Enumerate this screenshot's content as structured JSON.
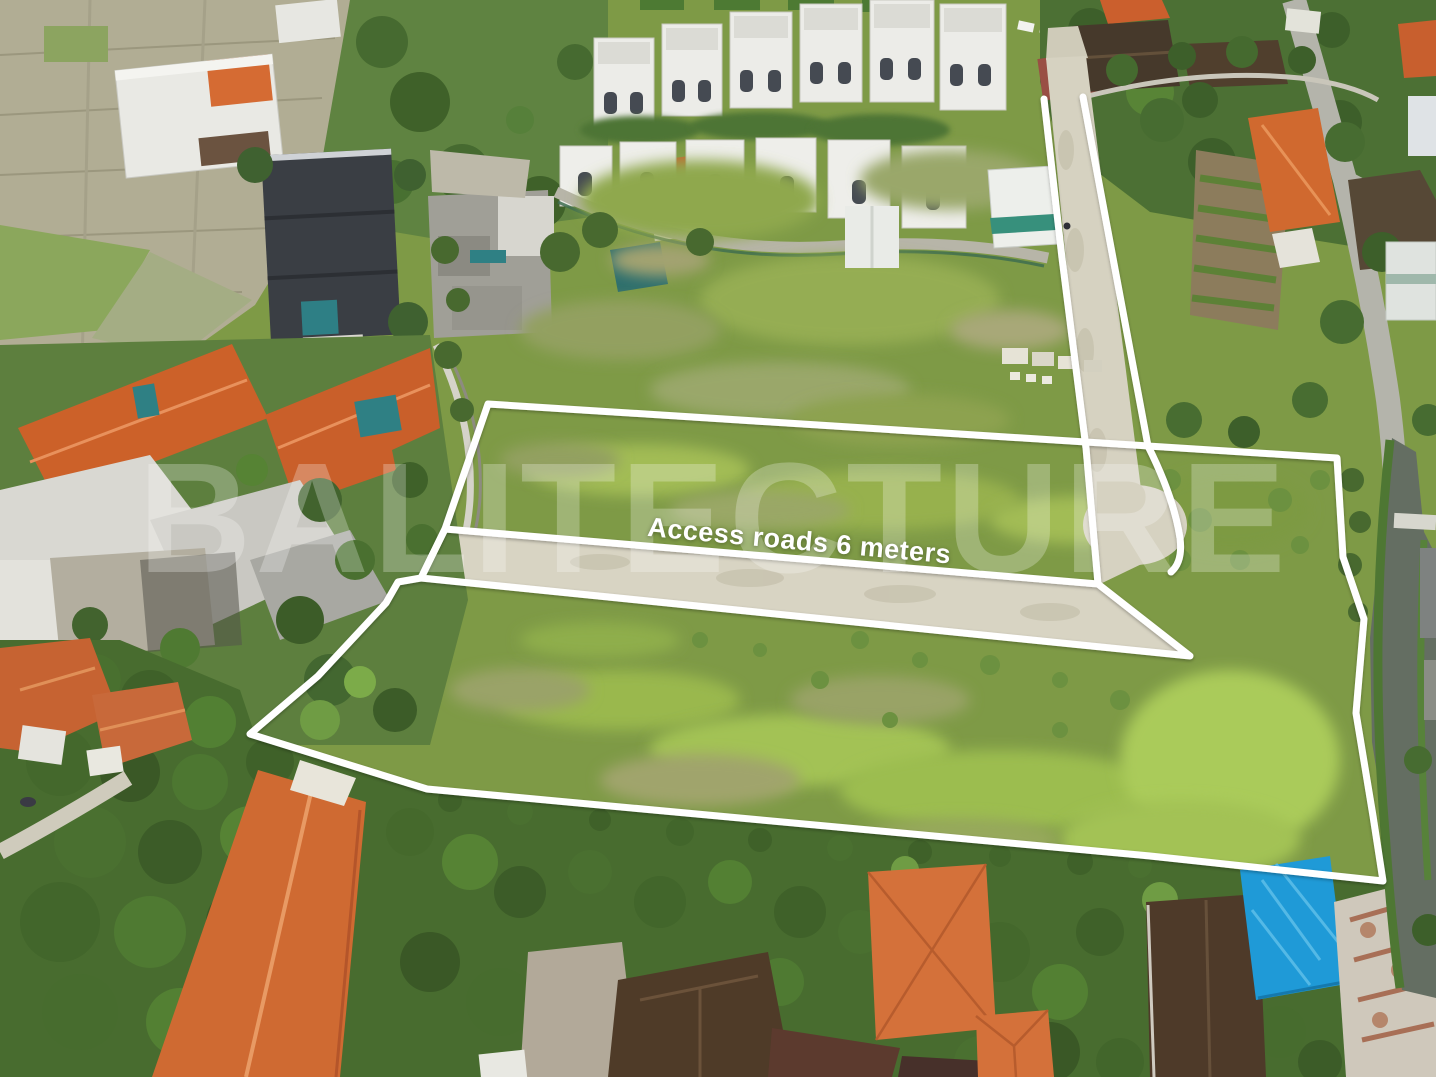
{
  "overlay": {
    "road_label": "Access roads 6 meters",
    "watermark": "BALITECTURE",
    "outline_color": "#ffffff"
  },
  "palette": {
    "grass": "#7e9a46",
    "lime_grass": "#a7c857",
    "dirt_road": "#d6d2c1",
    "roof_orange": "#cf6a32",
    "roof_dark_brown": "#4e3a29",
    "roof_charcoal": "#3a3e44",
    "rice_field_tan": "#b1ad94",
    "pool_teal": "#2e7f85",
    "tarp_blue": "#1f9ad7",
    "canal_water": "#646e62"
  }
}
